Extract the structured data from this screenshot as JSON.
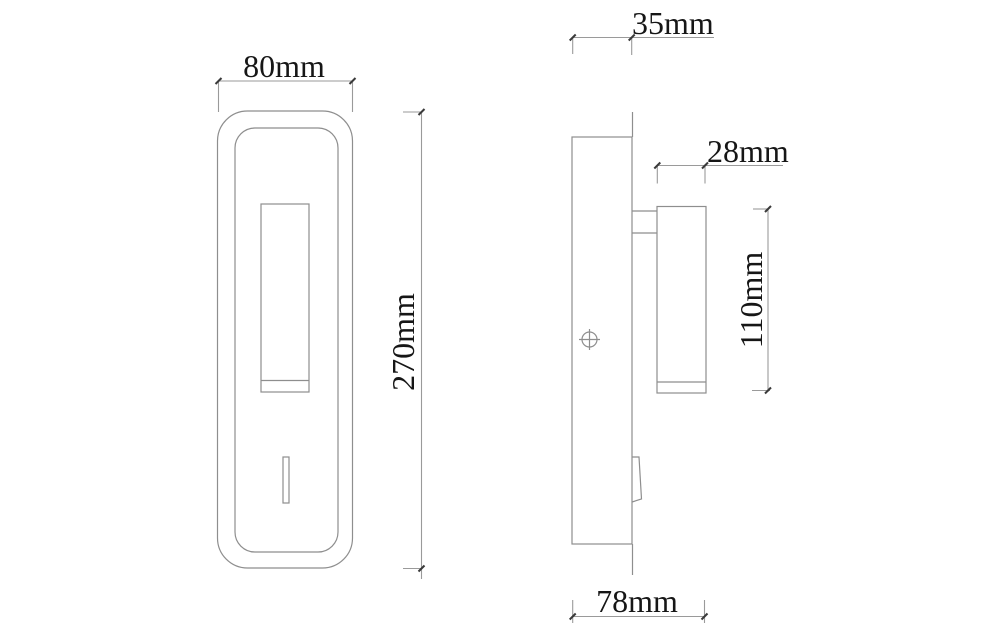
{
  "page": {
    "background_color": "#ffffff",
    "line_color": "#8e8e8e",
    "text_color": "#161616"
  },
  "drawing": {
    "description": "Two-view dimensional drawing of a rectangular wall lamp with reading light cylinder and switch",
    "views": [
      {
        "id": "front",
        "name": "front view"
      },
      {
        "id": "side",
        "name": "side view"
      }
    ],
    "dimensions": {
      "front_width": "80mm",
      "front_height": "270mm",
      "plate_depth": "35mm",
      "head_width": "28mm",
      "head_height": "110mm",
      "overall_depth": "78mm"
    }
  }
}
